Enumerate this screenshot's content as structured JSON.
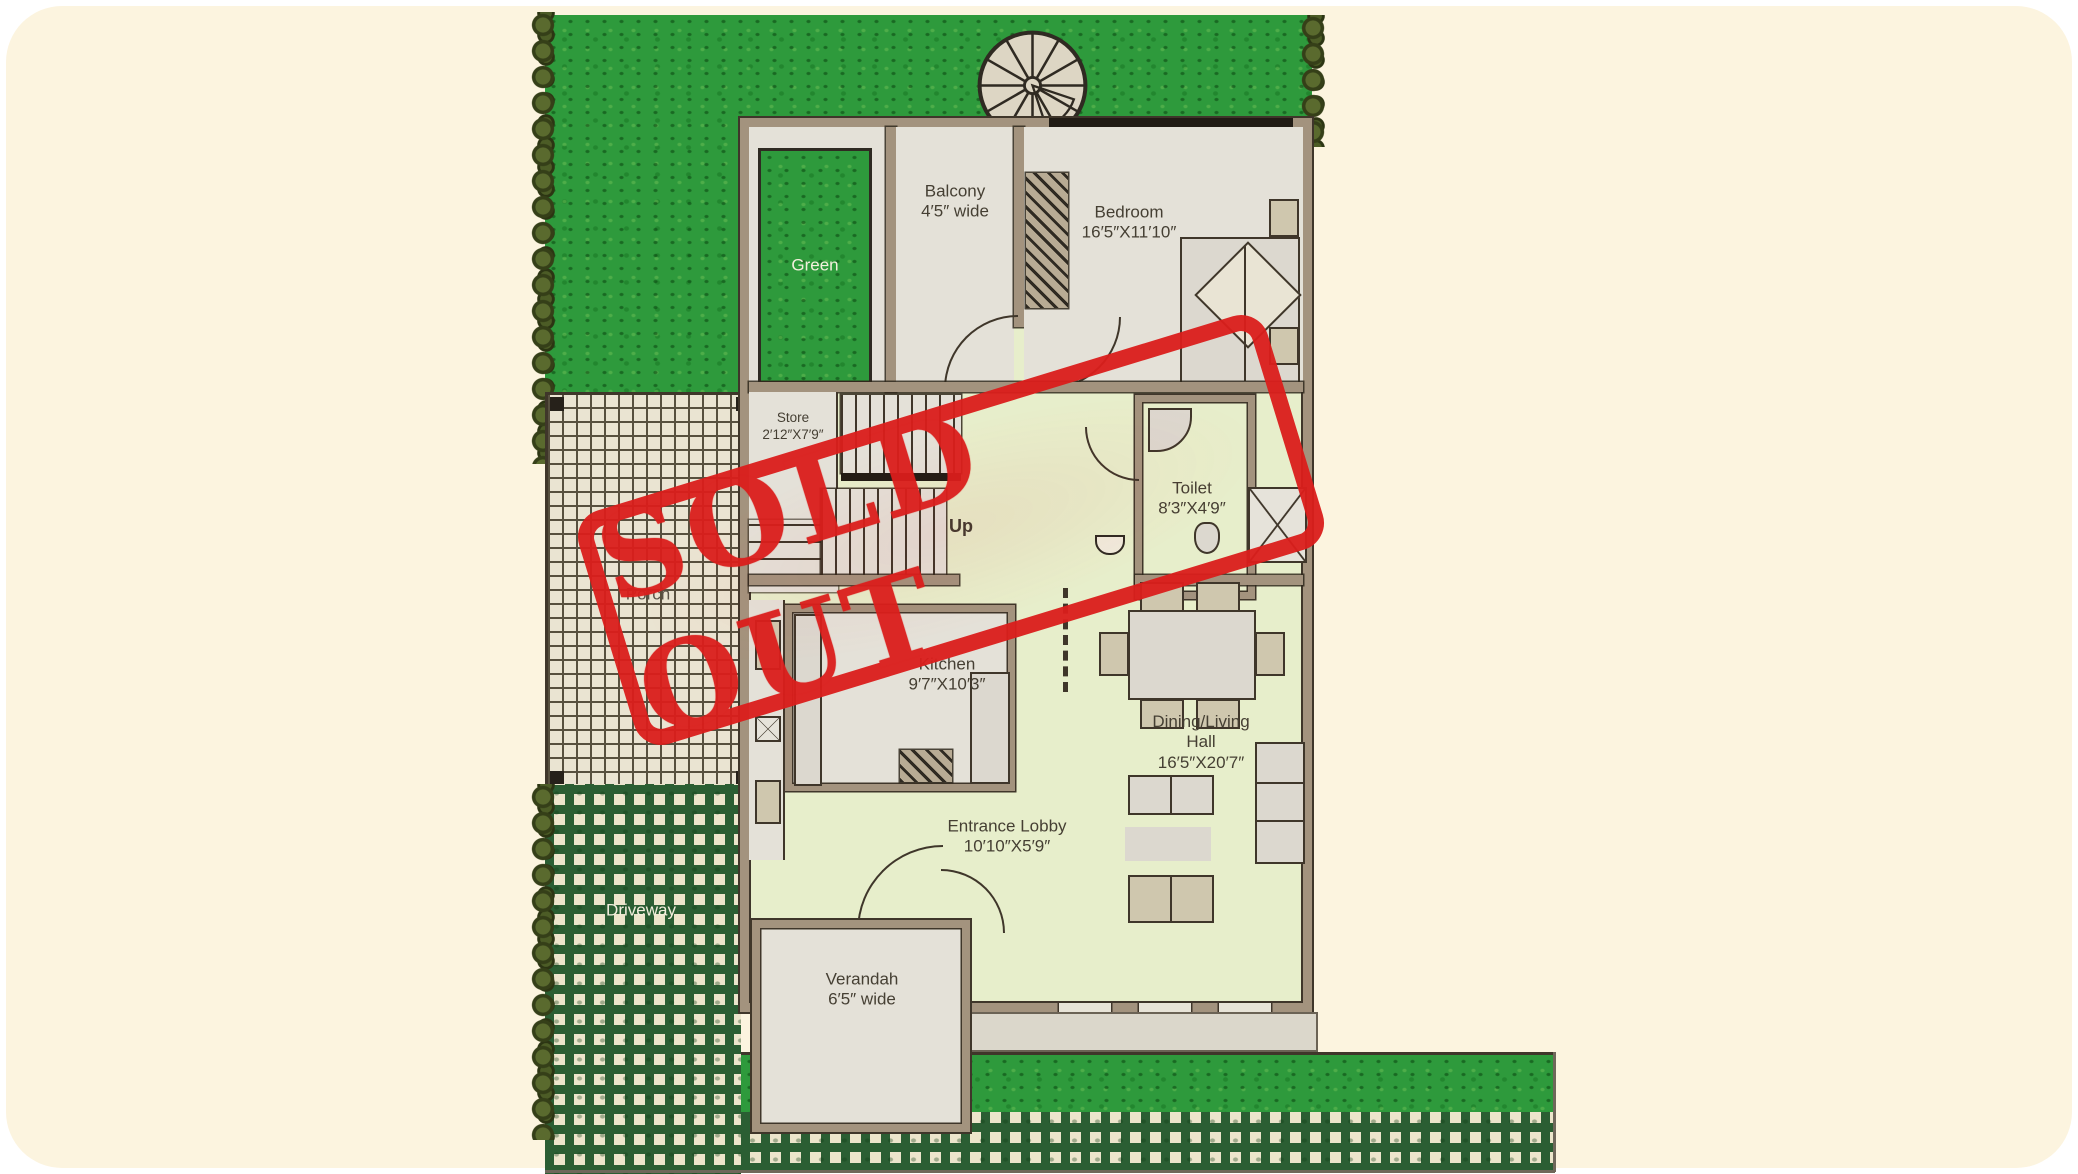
{
  "stamp": {
    "text": "SOLD OUT",
    "color": "#db1e1c"
  },
  "areas": {
    "green": {
      "label": "Green"
    },
    "balcony": {
      "label": "Balcony",
      "dim": "4′5″ wide"
    },
    "bedroom": {
      "label": "Bedroom",
      "dim": "16′5″X11′10″"
    },
    "store": {
      "label": "Store",
      "dim": "2′12″X7′9″"
    },
    "up": {
      "label": "Up"
    },
    "toilet": {
      "label": "Toilet",
      "dim": "8′3″X4′9″"
    },
    "kitchen": {
      "label": "Kitchen",
      "dim": "9′7″X10′3″"
    },
    "dining": {
      "label": "Dining/Living Hall",
      "dim": "16′5″X20′7″"
    },
    "lobby": {
      "label": "Entrance Lobby",
      "dim": "10′10″X5′9″"
    },
    "verandah": {
      "label": "Verandah",
      "dim": "6′5″ wide"
    },
    "porch": {
      "label": "Porch"
    },
    "driveway": {
      "label": "Driveway"
    }
  },
  "colors": {
    "background": "#fcf4df",
    "grass": "#2e9a3c",
    "room_green": "#e7eecb",
    "room_gray": "#e4e1d8",
    "wall": "#a3937e",
    "stamp_red": "#db1e1c",
    "driveway_dark": "#2b5e33"
  }
}
